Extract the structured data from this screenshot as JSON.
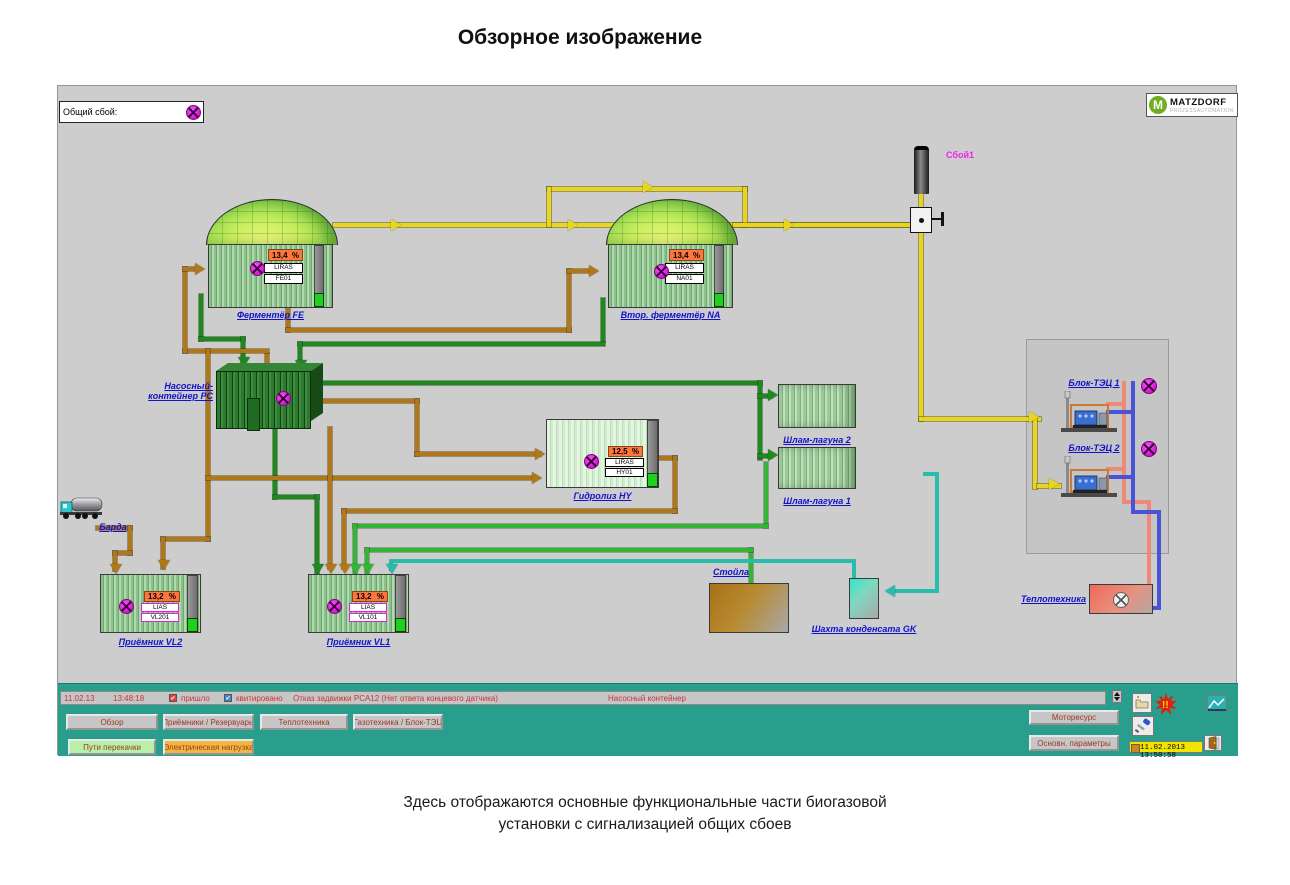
{
  "window": {
    "title": "Обзорное изображение",
    "caption_line1": "Здесь отображаются основные функциональные части биогазовой",
    "caption_line2": "установки с сигнализацией общих сбоев"
  },
  "header": {
    "general_fault_label": "Общий сбой:",
    "flare_alarm_label": "Сбой1",
    "logo_title": "MATZDORF",
    "logo_subtitle": "PROZESSAUTOMATION"
  },
  "units": {
    "fe": {
      "label": "Ферментёр FE",
      "value": "13,4",
      "unit": "%",
      "tag_type": "LIRAS",
      "tag_id": "FE01"
    },
    "na": {
      "label": "Втор. ферментёр NA",
      "value": "13,4",
      "unit": "%",
      "tag_type": "LIRAS",
      "tag_id": "NA01"
    },
    "pc": {
      "label1": "Насосный-",
      "label2": "контейнер PC"
    },
    "hy": {
      "label": "Гидролиз HY",
      "value": "12,5",
      "unit": "%",
      "tag_type": "LIRAS",
      "tag_id": "HY01"
    },
    "lagoon2": {
      "label": "Шлам-лагуна 2"
    },
    "lagoon1": {
      "label": "Шлам-лагуна 1"
    },
    "vl2": {
      "label": "Приёмник VL2",
      "value": "13,2",
      "unit": "%",
      "tag_type": "LIAS",
      "tag_id": "VL201"
    },
    "vl1": {
      "label": "Приёмник VL1",
      "value": "13,2",
      "unit": "%",
      "tag_type": "LIAS",
      "tag_id": "VL101"
    },
    "truck": {
      "label": "Барда"
    },
    "stables": {
      "label": "Стойла"
    },
    "gk": {
      "label": "Шахта конденсата GK"
    },
    "chp1": {
      "label": "Блок-ТЭЦ 1"
    },
    "chp2": {
      "label": "Блок-ТЭЦ 2"
    },
    "heat": {
      "label": "Теплотехника"
    }
  },
  "alarm": {
    "date": "11.02.13",
    "time": "13:48:18",
    "came_label": "пришло",
    "ack_label": "квитировано",
    "message": "Отказ задвижки PCA12 (Нет ответа концевого датчика)",
    "location": "Насосный контейнер"
  },
  "nav": {
    "row1": [
      "Обзор",
      "Приёмники / Резервуары",
      "Теплотехника",
      "Газотехника / Блок-ТЭЦ"
    ],
    "row2": [
      "Пути перекачки",
      "Электрическая нагрузка"
    ],
    "right": [
      "Моторесурс",
      "Основн. параметры"
    ],
    "datetime": "11.02.2013 13:50:58"
  },
  "colors": {
    "panel_bg": "#cdcdcd",
    "bar_teal": "#2a9e8c",
    "alarm_magenta": "#e820e8",
    "gas_yellow": "#e8d51e",
    "substrate_brown": "#b07818",
    "slurry_green": "#1e8a1e",
    "condensate_cyan": "#28bcaa",
    "heat_red": "#f08878",
    "heat_blue": "#4853d6",
    "active_button_green": "#b8f0a8",
    "active_button_orange": "#f0b840"
  }
}
